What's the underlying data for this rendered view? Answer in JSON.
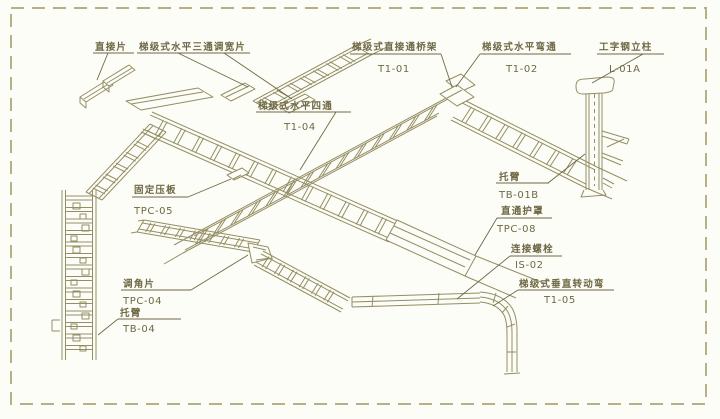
{
  "diagram": {
    "type": "cable-tray-installation-isometric",
    "border_style": "dashed",
    "colors": {
      "line": "#948e63",
      "text": "#6e6844",
      "background": "#fdfdf8",
      "border": "#b5b088"
    },
    "labels": {
      "direct_connector": {
        "name": "直接片"
      },
      "tee_width_adjuster": {
        "name": "梯级式水平三通调宽片"
      },
      "straight_through_tray": {
        "name": "梯级式直接通桥架",
        "code": "T1-01"
      },
      "horizontal_bend": {
        "name": "梯级式水平弯通",
        "code": "T1-02"
      },
      "i_beam_column": {
        "name": "工字钢立柱",
        "code": "L-01A"
      },
      "horizontal_cross": {
        "name": "梯级式水平四通",
        "code": "T1-04"
      },
      "fixing_clamp": {
        "name": "固定压板",
        "code": "TPC-05"
      },
      "bracket_arm_column": {
        "name": "托臂",
        "code": "TB-01B"
      },
      "straight_cover": {
        "name": "直通护罩",
        "code": "TPC-08"
      },
      "connecting_bolt": {
        "name": "连接螺栓",
        "code": "IS-02"
      },
      "vertical_rotating_bend": {
        "name": "梯级式垂直转动弯",
        "code": "T1-05"
      },
      "angle_adjuster": {
        "name": "调角片",
        "code": "TPC-04"
      },
      "bracket_arm_ladder": {
        "name": "托臂",
        "code": "TB-04"
      }
    }
  }
}
